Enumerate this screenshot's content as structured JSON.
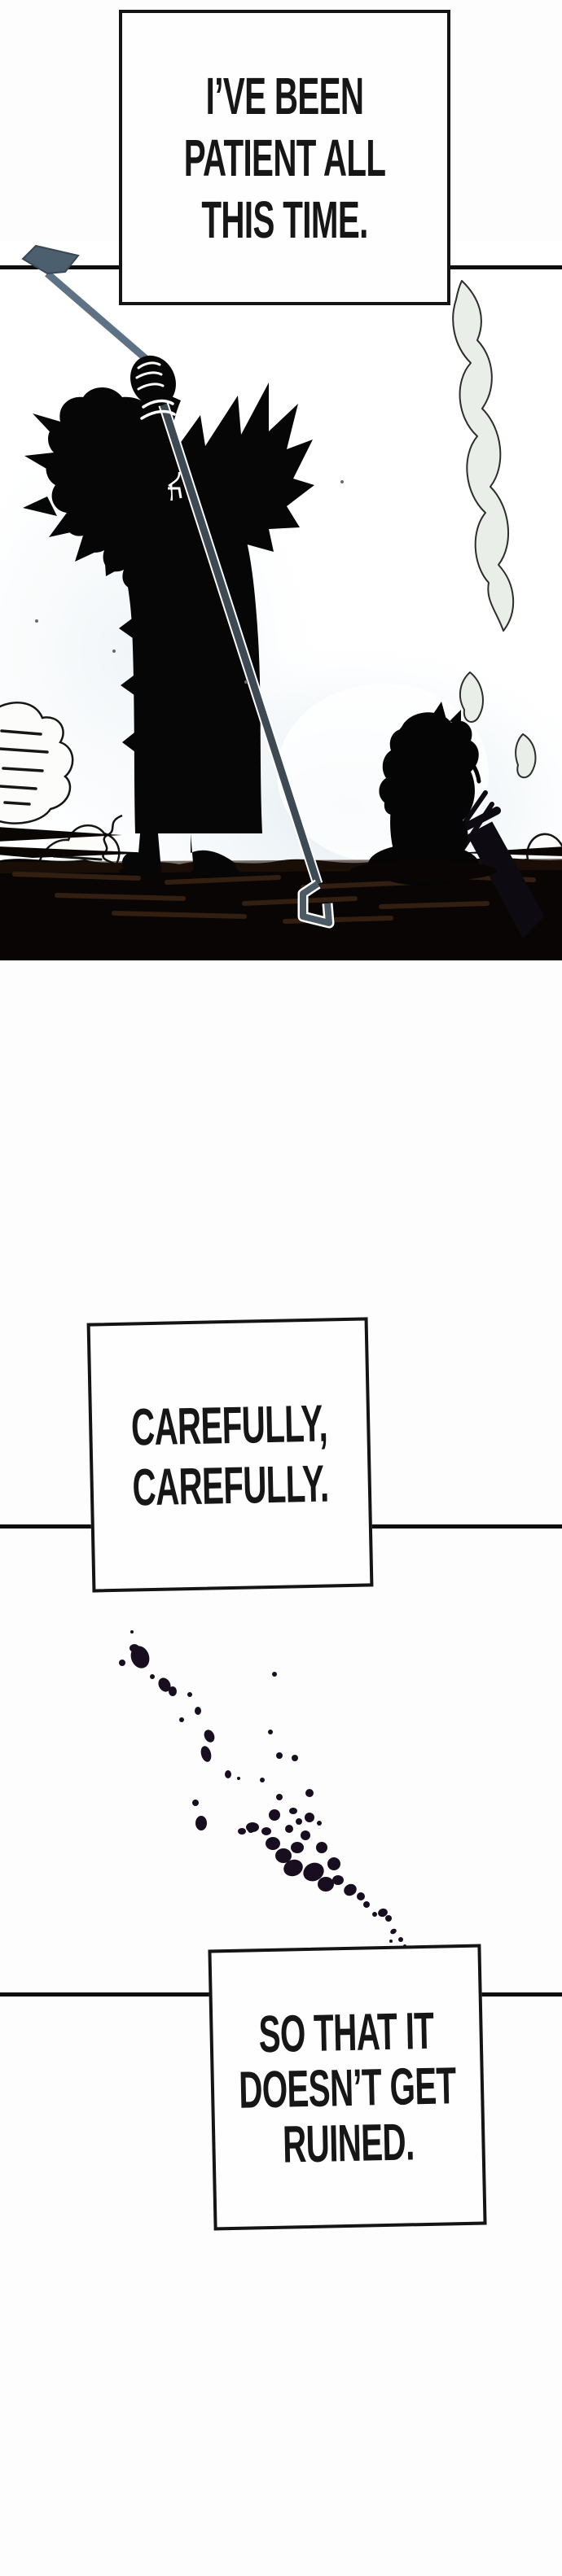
{
  "page_type": "webtoon-comic-strip",
  "dialogue": {
    "box1": {
      "lines": [
        "I’VE BEEN",
        "PATIENT ALL",
        "THIS TIME."
      ]
    },
    "box2": {
      "lines": [
        "CAREFULLY,",
        "CAREFULLY."
      ]
    },
    "box3": {
      "lines": [
        "SO THAT IT",
        "DOESN’T GET",
        "RUINED."
      ]
    }
  },
  "colors": {
    "page_background": "#fdfdfd",
    "panel_line": "#0e0e0e",
    "speech_border": "#141414",
    "speech_text": "#161616",
    "silhouette_black": "#060606",
    "staff_upper": "#5d7385",
    "staff_lower": "#3d4a54",
    "staff_hook": "#4c5f6e",
    "smoke_fill": "#e9eee8",
    "smoke_outline": "#2d2d2d",
    "ground_black": "#080504",
    "ground_brown_streak": "#3a2414",
    "bush_fill": "#fcfcfb",
    "bush_outline": "#161616",
    "splatter": "#190e20",
    "glow_tint": "#dfe9ef"
  }
}
